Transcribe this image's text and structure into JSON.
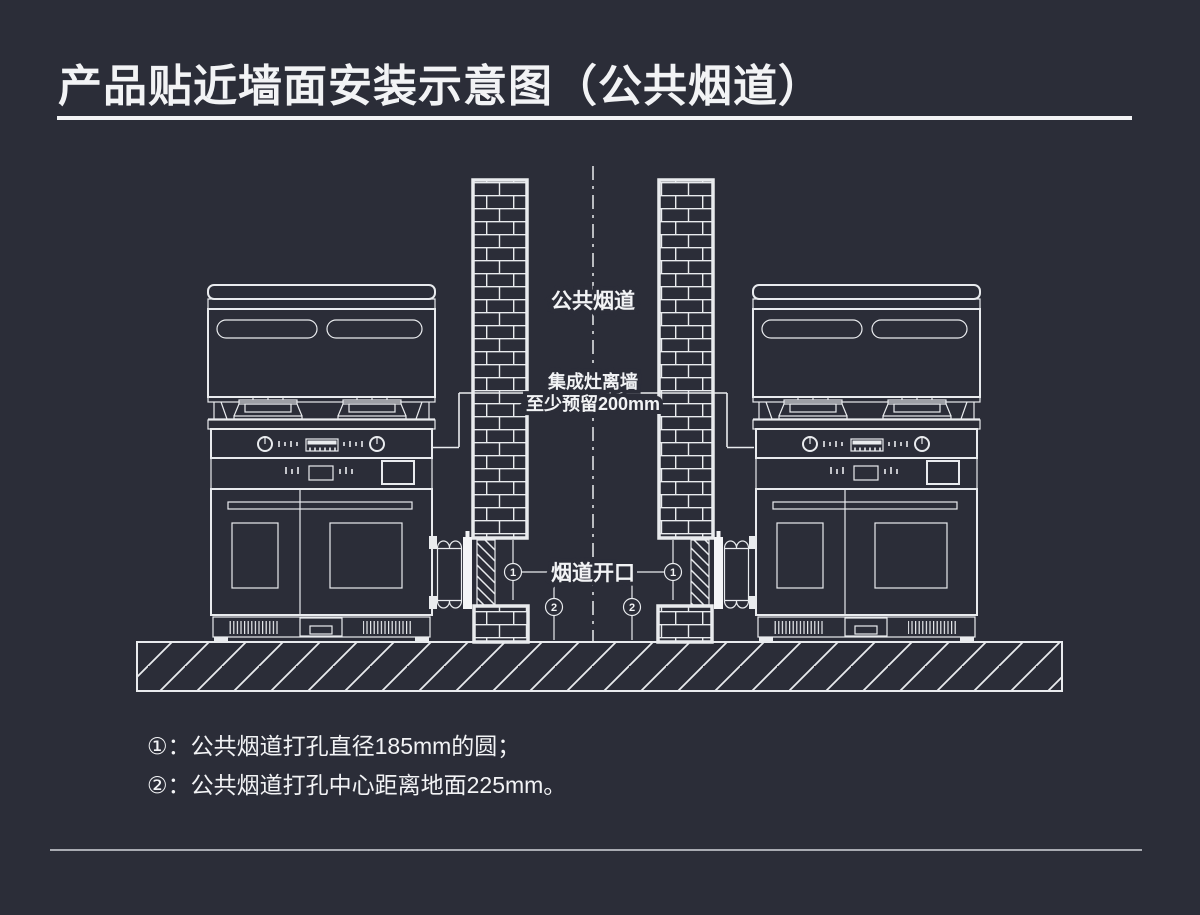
{
  "title": "产品贴近墙面安装示意图（公共烟道）",
  "diagram": {
    "label_flue": "公共烟道",
    "label_gap_1": "集成灶离墙",
    "label_gap_2": "至少预留200mm",
    "label_opening": "烟道开口",
    "callout_1": "1",
    "callout_2": "2"
  },
  "notes": {
    "note_1": "①：公共烟道打孔直径185mm的圆；",
    "note_2": "②：公共烟道打孔中心距离地面225mm。"
  },
  "colors": {
    "bg": "#2b2d38",
    "line": "#e9ebee",
    "text": "#f2f3f5",
    "divider": "#a9abb2"
  }
}
